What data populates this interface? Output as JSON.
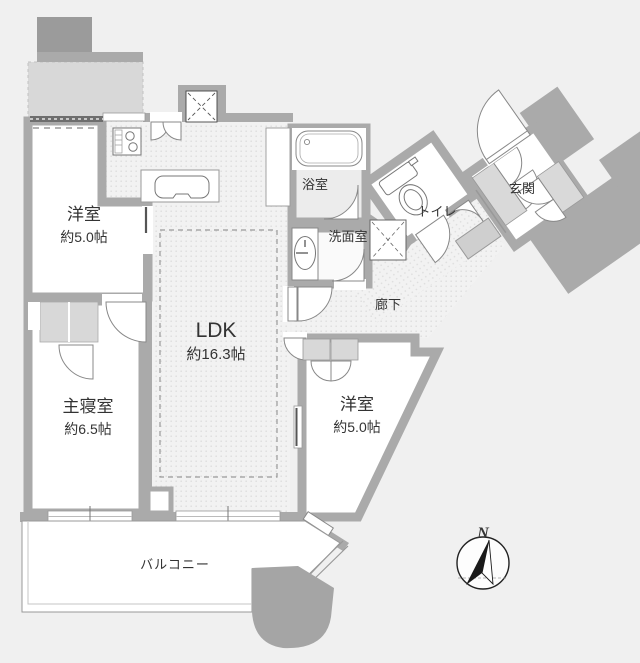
{
  "title": "マンション間取り図",
  "rooms": {
    "bedroom_west": {
      "name": "洋室",
      "size": "約5.0帖"
    },
    "ldk": {
      "name": "LDK",
      "size": "約16.3帖"
    },
    "master_bedroom": {
      "name": "主寝室",
      "size": "約6.5帖"
    },
    "bedroom_east": {
      "name": "洋室",
      "size": "約5.0帖"
    },
    "bathroom": {
      "name": "浴室"
    },
    "washroom": {
      "name": "洗面室"
    },
    "toilet": {
      "name": "トイレ"
    },
    "entrance": {
      "name": "玄関"
    },
    "hallway": {
      "name": "廊下"
    },
    "balcony": {
      "name": "バルコニー"
    }
  },
  "compass": {
    "north_label": "N"
  },
  "colors": {
    "background": "#f0f0f0",
    "wall": "#aaaaaa",
    "wall_dark": "#9b9b9b",
    "exterior_light": "#d8d8d8",
    "floor_dotted": "#f2f2f2",
    "room_white": "#ffffff",
    "text": "#333333"
  }
}
